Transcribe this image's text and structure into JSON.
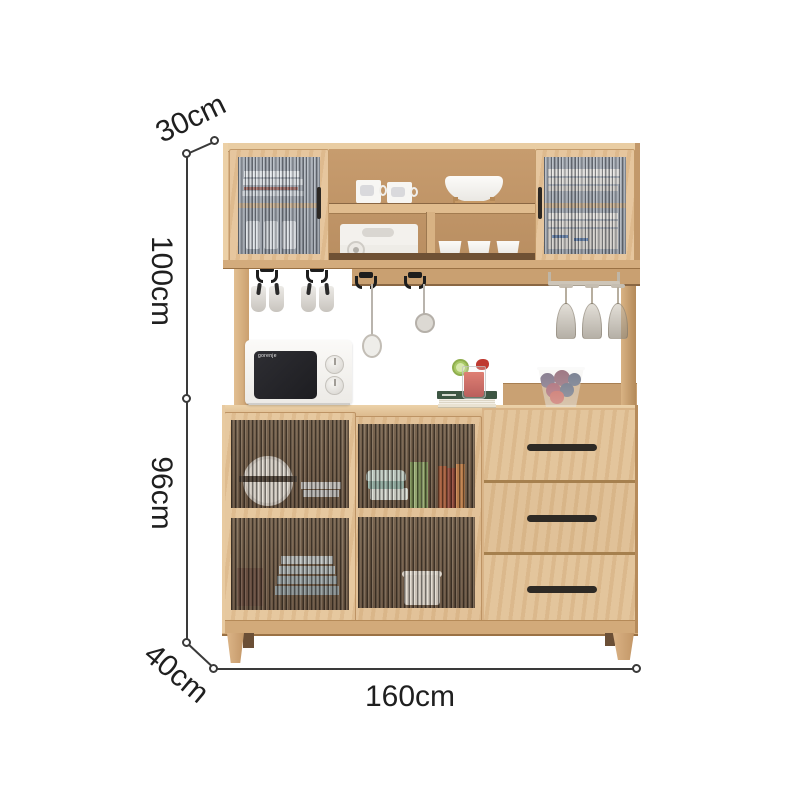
{
  "image": {
    "type": "product-dimension-diagram",
    "subject": "Light oak kitchen sideboard with glass-door hutch, hook rail, sliding-glass base cabinet and three drawers",
    "background": "#ffffff"
  },
  "dimensions": {
    "top_depth": "30cm",
    "upper_height": "100cm",
    "lower_height": "96cm",
    "base_depth": "40cm",
    "width": "160cm"
  },
  "microwave": {
    "brand": "gorenje"
  },
  "visible_items": [
    "glass-door cabinet",
    "mugs",
    "serving bowl on wooden stand",
    "storage box",
    "white cups",
    "hanging hooks with cups",
    "whisk",
    "skimmer",
    "wine glass rack with stemware",
    "microwave",
    "cocktail with lime",
    "green book",
    "glass bowl with fruit",
    "plates behind fluted glass",
    "three drawers"
  ],
  "palette": {
    "wood": "#d8b285",
    "wood_light": "#e9cda3",
    "wood_frame": "#e2c094",
    "wood_interior": "#bd9265",
    "wood_shadow": "#8a6743",
    "handle_black": "#2b2723",
    "dimension_line": "#3a3a3a",
    "glass_cool": "#a6acb4",
    "glass_warm": "#6b5442"
  }
}
